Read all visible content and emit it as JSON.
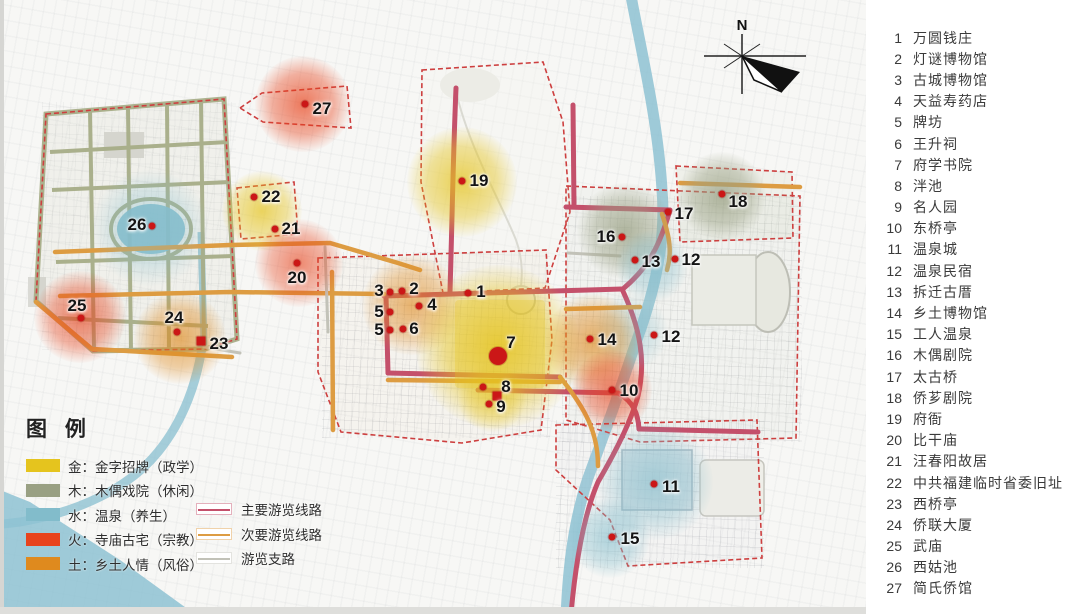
{
  "map": {
    "north_label": "N",
    "marker_color": "#cb1717",
    "markers": [
      {
        "n": "1",
        "x": 468,
        "y": 293,
        "lx": 481,
        "ly": 292
      },
      {
        "n": "2",
        "x": 402,
        "y": 291,
        "lx": 414,
        "ly": 289
      },
      {
        "n": "3",
        "x": 390,
        "y": 292,
        "lx": 379,
        "ly": 291
      },
      {
        "n": "4",
        "x": 419,
        "y": 306,
        "lx": 432,
        "ly": 305
      },
      {
        "n": "5",
        "x": 390,
        "y": 312,
        "lx": 379,
        "ly": 312
      },
      {
        "n": "5",
        "x": 390,
        "y": 330,
        "lx": 379,
        "ly": 330
      },
      {
        "n": "6",
        "x": 403,
        "y": 329,
        "lx": 414,
        "ly": 329
      },
      {
        "n": "7",
        "x": 498,
        "y": 356,
        "lx": 511,
        "ly": 343,
        "shape": "big"
      },
      {
        "n": "8",
        "x": 483,
        "y": 387,
        "lx": 506,
        "ly": 387
      },
      {
        "n": "",
        "x": 497,
        "y": 396,
        "shape": "square"
      },
      {
        "n": "9",
        "x": 489,
        "y": 404,
        "lx": 501,
        "ly": 407
      },
      {
        "n": "10",
        "x": 612,
        "y": 390,
        "lx": 629,
        "ly": 391
      },
      {
        "n": "11",
        "x": 654,
        "y": 484,
        "lx": 671,
        "ly": 487
      },
      {
        "n": "12",
        "x": 675,
        "y": 259,
        "lx": 691,
        "ly": 260
      },
      {
        "n": "12",
        "x": 654,
        "y": 335,
        "lx": 671,
        "ly": 337
      },
      {
        "n": "13",
        "x": 635,
        "y": 260,
        "lx": 651,
        "ly": 262
      },
      {
        "n": "14",
        "x": 590,
        "y": 339,
        "lx": 607,
        "ly": 340
      },
      {
        "n": "15",
        "x": 612,
        "y": 537,
        "lx": 630,
        "ly": 539
      },
      {
        "n": "16",
        "x": 622,
        "y": 237,
        "lx": 606,
        "ly": 237
      },
      {
        "n": "17",
        "x": 668,
        "y": 212,
        "lx": 684,
        "ly": 214
      },
      {
        "n": "18",
        "x": 722,
        "y": 194,
        "lx": 738,
        "ly": 202
      },
      {
        "n": "19",
        "x": 462,
        "y": 181,
        "lx": 479,
        "ly": 181
      },
      {
        "n": "20",
        "x": 297,
        "y": 263,
        "lx": 297,
        "ly": 278
      },
      {
        "n": "21",
        "x": 275,
        "y": 229,
        "lx": 291,
        "ly": 229
      },
      {
        "n": "22",
        "x": 254,
        "y": 197,
        "lx": 271,
        "ly": 197
      },
      {
        "n": "23",
        "x": 201,
        "y": 341,
        "lx": 219,
        "ly": 344,
        "shape": "square"
      },
      {
        "n": "24",
        "x": 177,
        "y": 332,
        "lx": 174,
        "ly": 318
      },
      {
        "n": "25",
        "x": 81,
        "y": 318,
        "lx": 77,
        "ly": 306
      },
      {
        "n": "26",
        "x": 152,
        "y": 226,
        "lx": 137,
        "ly": 225
      },
      {
        "n": "27",
        "x": 305,
        "y": 104,
        "lx": 322,
        "ly": 109
      }
    ],
    "blobs": [
      {
        "cat": "火",
        "x": 303,
        "y": 104,
        "r": 48,
        "o": 0.8
      },
      {
        "cat": "金",
        "x": 462,
        "y": 182,
        "r": 55,
        "o": 0.85
      },
      {
        "cat": "金",
        "x": 262,
        "y": 211,
        "r": 40,
        "o": 0.8
      },
      {
        "cat": "火",
        "x": 299,
        "y": 263,
        "r": 44,
        "o": 0.7
      },
      {
        "cat": "火",
        "x": 80,
        "y": 317,
        "r": 46,
        "o": 0.75
      },
      {
        "cat": "土",
        "x": 180,
        "y": 338,
        "r": 46,
        "o": 0.75
      },
      {
        "cat": "水",
        "x": 150,
        "y": 228,
        "r": 58,
        "o": 0.5
      },
      {
        "cat": "土",
        "x": 412,
        "y": 305,
        "r": 50,
        "o": 0.7
      },
      {
        "cat": "金",
        "x": 498,
        "y": 347,
        "r": 82,
        "o": 0.95
      },
      {
        "cat": "金",
        "x": 492,
        "y": 398,
        "r": 34,
        "o": 0.55
      },
      {
        "cat": "木",
        "x": 625,
        "y": 231,
        "r": 48,
        "o": 0.85
      },
      {
        "cat": "木",
        "x": 722,
        "y": 196,
        "r": 44,
        "o": 0.85
      },
      {
        "cat": "水",
        "x": 652,
        "y": 266,
        "r": 36,
        "o": 0.6
      },
      {
        "cat": "水",
        "x": 630,
        "y": 332,
        "r": 38,
        "o": 0.45
      },
      {
        "cat": "土",
        "x": 593,
        "y": 342,
        "r": 48,
        "o": 0.75
      },
      {
        "cat": "火",
        "x": 612,
        "y": 390,
        "r": 40,
        "o": 0.75
      },
      {
        "cat": "水",
        "x": 655,
        "y": 482,
        "r": 58,
        "o": 0.7
      },
      {
        "cat": "水",
        "x": 610,
        "y": 538,
        "r": 40,
        "o": 0.7
      }
    ],
    "patches": [
      {
        "cat": "金",
        "x": 455,
        "y": 300,
        "w": 90,
        "h": 88,
        "o": 0.5
      }
    ],
    "roads": [
      {
        "t": "main",
        "d": "M456,88 C453,160 452,225 450,292"
      },
      {
        "t": "main",
        "d": "M384,296 L622,289"
      },
      {
        "t": "main",
        "d": "M386,296 L388,373"
      },
      {
        "t": "main",
        "d": "M388,373 L560,377"
      },
      {
        "t": "main",
        "d": "M622,289 C641,330 646,362 638,396 C630,425 612,458 598,482 C585,512 576,558 571,614"
      },
      {
        "t": "main",
        "d": "M573,105 L574,206"
      },
      {
        "t": "main",
        "d": "M566,207 L670,210"
      },
      {
        "t": "main",
        "d": "M670,210 C660,245 648,268 624,288"
      },
      {
        "t": "main",
        "d": "M478,390 L618,393"
      },
      {
        "t": "main",
        "d": "M618,393 C634,402 638,414 639,429"
      },
      {
        "t": "main",
        "d": "M639,429 L758,432"
      },
      {
        "t": "secondary",
        "d": "M55,252 L230,245 L330,243 L398,263 L420,270"
      },
      {
        "t": "secondary",
        "d": "M36,302 L92,349 L232,357"
      },
      {
        "t": "secondary",
        "d": "M60,296 L230,292 L384,294"
      },
      {
        "t": "secondary",
        "d": "M332,272 L333,430"
      },
      {
        "t": "secondary",
        "d": "M388,380 L560,382"
      },
      {
        "t": "secondary",
        "d": "M560,377 C585,408 598,432 598,466"
      },
      {
        "t": "secondary",
        "d": "M680,183 L800,187"
      },
      {
        "t": "secondary",
        "d": "M662,214 C670,238 672,252 667,270"
      },
      {
        "t": "secondary",
        "d": "M566,309 L640,307"
      },
      {
        "t": "branch",
        "d": "M204,347 L240,353"
      },
      {
        "t": "branch",
        "d": "M568,253 L620,256"
      },
      {
        "t": "branch",
        "d": "M325,247 L328,332"
      }
    ]
  },
  "legend": {
    "title": "图 例",
    "categories": [
      {
        "key": "金",
        "label": "金：金字招牌（政学）",
        "color": "#e5c41e"
      },
      {
        "key": "木",
        "label": "木：木偶戏院（休闲）",
        "color": "#99a083"
      },
      {
        "key": "水",
        "label": "水：温泉（养生）",
        "color": "#82bccb"
      },
      {
        "key": "火",
        "label": "火：寺庙古宅（宗教）",
        "color": "#e8431c"
      },
      {
        "key": "土",
        "label": "土：乡土人情（风俗）",
        "color": "#df8a1e"
      }
    ],
    "routes": [
      {
        "label": "主要游览线路",
        "color": "#c4506b"
      },
      {
        "label": "次要游览线路",
        "color": "#dd9c42"
      },
      {
        "label": "游览支路",
        "color": "#c2c2b8"
      }
    ]
  },
  "poi_list": [
    {
      "num": "1",
      "name": "万圆钱庄"
    },
    {
      "num": "2",
      "name": "灯谜博物馆"
    },
    {
      "num": "3",
      "name": "古城博物馆"
    },
    {
      "num": "4",
      "name": "天益寿药店"
    },
    {
      "num": "5",
      "name": "牌坊"
    },
    {
      "num": "6",
      "name": "王升祠"
    },
    {
      "num": "7",
      "name": "府学书院"
    },
    {
      "num": "8",
      "name": "泮池"
    },
    {
      "num": "9",
      "name": "名人园"
    },
    {
      "num": "10",
      "name": "东桥亭"
    },
    {
      "num": "11",
      "name": "温泉城"
    },
    {
      "num": "12",
      "name": "温泉民宿"
    },
    {
      "num": "13",
      "name": "拆迁古厝"
    },
    {
      "num": "14",
      "name": "乡土博物馆"
    },
    {
      "num": "15",
      "name": "工人温泉"
    },
    {
      "num": "16",
      "name": "木偶剧院"
    },
    {
      "num": "17",
      "name": "太古桥"
    },
    {
      "num": "18",
      "name": "侨芗剧院"
    },
    {
      "num": "19",
      "name": "府衙"
    },
    {
      "num": "20",
      "name": "比干庙"
    },
    {
      "num": "21",
      "name": "汪春阳故居"
    },
    {
      "num": "22",
      "name": "中共福建临时省委旧址"
    },
    {
      "num": "23",
      "name": "西桥亭"
    },
    {
      "num": "24",
      "name": "侨联大厦"
    },
    {
      "num": "25",
      "name": "武庙"
    },
    {
      "num": "26",
      "name": "西姑池"
    },
    {
      "num": "27",
      "name": "简氏侨馆"
    }
  ]
}
